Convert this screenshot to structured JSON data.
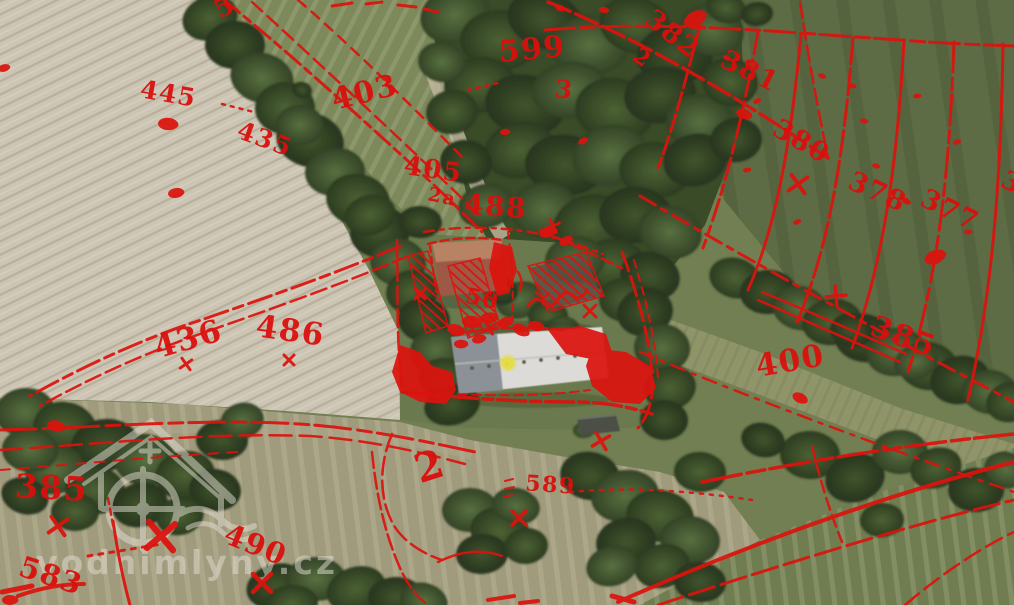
{
  "map": {
    "description": "aerial orthophoto with historic cadastral overlay",
    "overlay_color": "#e80802",
    "watermark": {
      "text": "vodnimlyny.cz",
      "icon": "watermill-house-icon",
      "color": "#f1ece0",
      "opacity": 0.5
    },
    "marker": {
      "label": "mill-location",
      "color": "#f2e93c",
      "x": 508,
      "y": 363
    },
    "parcel_labels": [
      {
        "text": "5",
        "x": 229,
        "y": 14,
        "rot": -30,
        "size": 26
      },
      {
        "text": "2",
        "x": 638,
        "y": 64,
        "rot": 35,
        "size": 22
      },
      {
        "text": "382",
        "x": 667,
        "y": 41,
        "rot": 38,
        "size": 27
      },
      {
        "text": "381",
        "x": 746,
        "y": 79,
        "rot": 26,
        "size": 27
      },
      {
        "text": "380",
        "x": 797,
        "y": 149,
        "rot": 30,
        "size": 27
      },
      {
        "text": "378",
        "x": 874,
        "y": 200,
        "rot": 24,
        "size": 27
      },
      {
        "text": "377",
        "x": 946,
        "y": 218,
        "rot": 26,
        "size": 27
      },
      {
        "text": "3",
        "x": 1008,
        "y": 190,
        "rot": 26,
        "size": 26
      },
      {
        "text": "445",
        "x": 167,
        "y": 102,
        "rot": 10,
        "size": 25
      },
      {
        "text": "435",
        "x": 262,
        "y": 147,
        "rot": 20,
        "size": 25
      },
      {
        "text": "403",
        "x": 367,
        "y": 102,
        "rot": -14,
        "size": 30
      },
      {
        "text": "599",
        "x": 533,
        "y": 59,
        "rot": -5,
        "size": 30
      },
      {
        "text": "3",
        "x": 563,
        "y": 98,
        "rot": 8,
        "size": 25
      },
      {
        "text": "405",
        "x": 432,
        "y": 178,
        "rot": 8,
        "size": 26
      },
      {
        "text": "2a",
        "x": 441,
        "y": 203,
        "rot": 12,
        "size": 19
      },
      {
        "text": "488",
        "x": 495,
        "y": 216,
        "rot": 4,
        "size": 28
      },
      {
        "text": "436",
        "x": 191,
        "y": 349,
        "rot": -16,
        "size": 31
      },
      {
        "text": "486",
        "x": 289,
        "y": 341,
        "rot": 8,
        "size": 31
      },
      {
        "text": "400",
        "x": 792,
        "y": 371,
        "rot": -10,
        "size": 31
      },
      {
        "text": "385",
        "x": 900,
        "y": 346,
        "rot": 20,
        "size": 30
      },
      {
        "text": "385",
        "x": 51,
        "y": 499,
        "rot": 3,
        "size": 33
      },
      {
        "text": "583",
        "x": 48,
        "y": 585,
        "rot": 18,
        "size": 29
      },
      {
        "text": "490",
        "x": 252,
        "y": 554,
        "rot": 22,
        "size": 29
      },
      {
        "text": "589",
        "x": 550,
        "y": 492,
        "rot": 4,
        "size": 22
      },
      {
        "text": "2",
        "x": 434,
        "y": 479,
        "rot": -18,
        "size": 40
      },
      {
        "text": "50",
        "x": 481,
        "y": 306,
        "rot": 12,
        "size": 22
      }
    ],
    "x_marks": [
      [
        58,
        526,
        8,
        10
      ],
      [
        161,
        536,
        13,
        5
      ],
      [
        262,
        583,
        9,
        0
      ],
      [
        601,
        441,
        7,
        15
      ],
      [
        519,
        518,
        7,
        0
      ],
      [
        798,
        184,
        8,
        10
      ],
      [
        289,
        360,
        5,
        0
      ],
      [
        186,
        364,
        5,
        10
      ],
      [
        590,
        311,
        6,
        0
      ],
      [
        489,
        328,
        5,
        15
      ],
      [
        836,
        296,
        7,
        40
      ],
      [
        553,
        226,
        5,
        20
      ],
      [
        420,
        294,
        5,
        0
      ]
    ],
    "blobs": [
      [
        695,
        19,
        12
      ],
      [
        744,
        114,
        8
      ],
      [
        168,
        124,
        10
      ],
      [
        176,
        193,
        8
      ],
      [
        935,
        257,
        11
      ],
      [
        800,
        398,
        8
      ],
      [
        56,
        426,
        9
      ],
      [
        10,
        600,
        8
      ],
      [
        4,
        68,
        6
      ],
      [
        757,
        101,
        4
      ],
      [
        822,
        76,
        4
      ],
      [
        864,
        121,
        4
      ],
      [
        917,
        96,
        4
      ],
      [
        957,
        142,
        4
      ],
      [
        906,
        201,
        5
      ],
      [
        876,
        166,
        4
      ],
      [
        968,
        232,
        4
      ],
      [
        747,
        170,
        4
      ],
      [
        797,
        222,
        4
      ],
      [
        727,
        58,
        4
      ],
      [
        852,
        86,
        4
      ],
      [
        505,
        132,
        5
      ],
      [
        548,
        232,
        9
      ],
      [
        566,
        241,
        7
      ],
      [
        456,
        330,
        9
      ],
      [
        472,
        322,
        10
      ],
      [
        489,
        318,
        9
      ],
      [
        506,
        322,
        8
      ],
      [
        521,
        330,
        9
      ],
      [
        536,
        326,
        8
      ],
      [
        461,
        344,
        7
      ],
      [
        479,
        339,
        7
      ],
      [
        583,
        141,
        5
      ],
      [
        560,
        8,
        5
      ],
      [
        604,
        10,
        5
      ]
    ]
  }
}
